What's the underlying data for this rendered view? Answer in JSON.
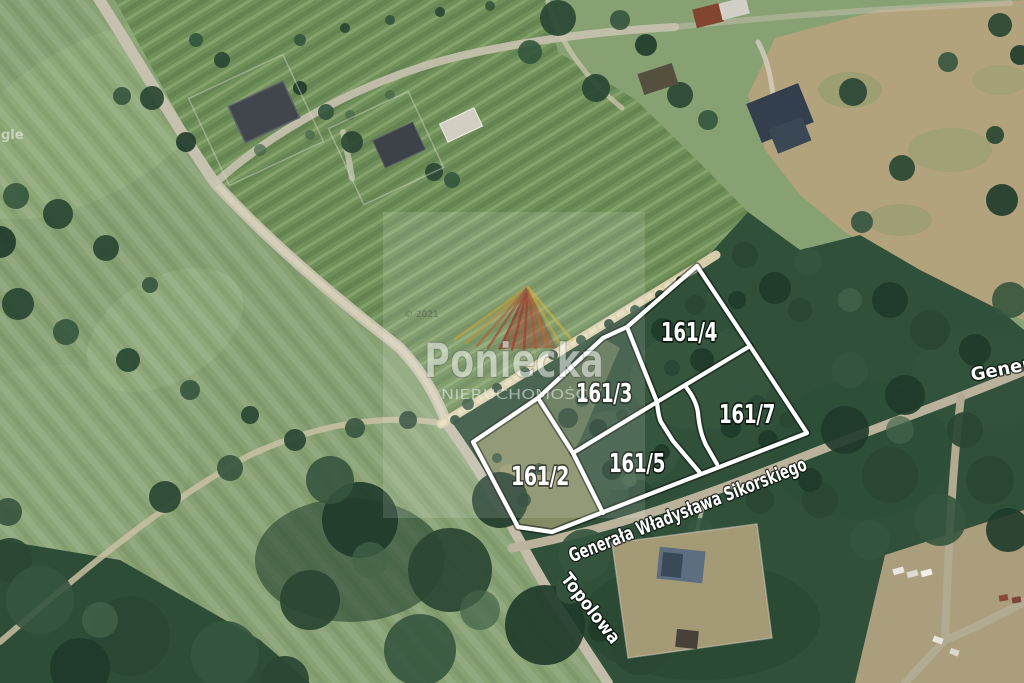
{
  "image": {
    "kind": "satellite-parcel-map",
    "width": 1024,
    "height": 683
  },
  "parcels": {
    "items": [
      {
        "id": "161/2",
        "label": "161/2"
      },
      {
        "id": "161/3",
        "label": "161/3"
      },
      {
        "id": "161/4",
        "label": "161/4"
      },
      {
        "id": "161/5",
        "label": "161/5"
      },
      {
        "id": "161/7",
        "label": "161/7"
      }
    ],
    "boundary_color": "#ffffff",
    "label_outline_color": "#000000"
  },
  "streets": {
    "main": "Generała Władysława Sikorskiego",
    "side": "Topolowa",
    "edge_partial": "Generała"
  },
  "watermark": {
    "brand": "Poniecka",
    "subtitle": "NIERUCHOMOŚCI",
    "imagery_credit": "© 2021",
    "logo_red": "#9c2f26",
    "logo_gold": "#d9a832"
  },
  "artifacts": {
    "logo_fragment": "gle"
  }
}
